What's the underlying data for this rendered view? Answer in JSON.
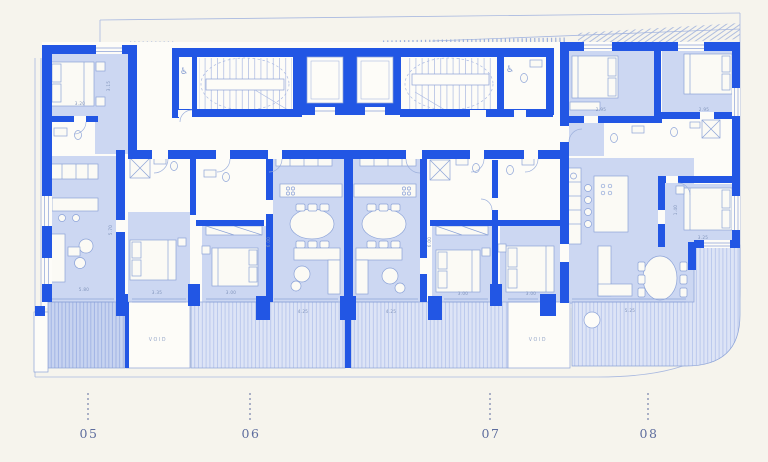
{
  "palette": {
    "background": "#f6f4ed",
    "wall_blue": "#2256e4",
    "room_fill": "#ccd7f2",
    "terrace_fill_light": "#dde4f6",
    "terrace_fill_dark": "#c7d3f0",
    "stripe_blue": "#b7c5ec",
    "thin_line": "#8ca3d8",
    "label_text": "#5e6d9e",
    "dim_text": "#8094bb"
  },
  "plan": {
    "void_label": "VOID",
    "units": [
      {
        "label": "05"
      },
      {
        "label": "06"
      },
      {
        "label": "07"
      },
      {
        "label": "08"
      }
    ],
    "dimensions": [
      "3.20",
      "3.15",
      "5.70",
      "5.80",
      "4.25",
      "4.25",
      "6.00",
      "6.00",
      "3.35",
      "3.00",
      "3.00",
      "3.00",
      "2.95",
      "2.95",
      "1.40",
      "3.25",
      "5.25"
    ],
    "icons": {
      "accessible": "♿"
    }
  }
}
